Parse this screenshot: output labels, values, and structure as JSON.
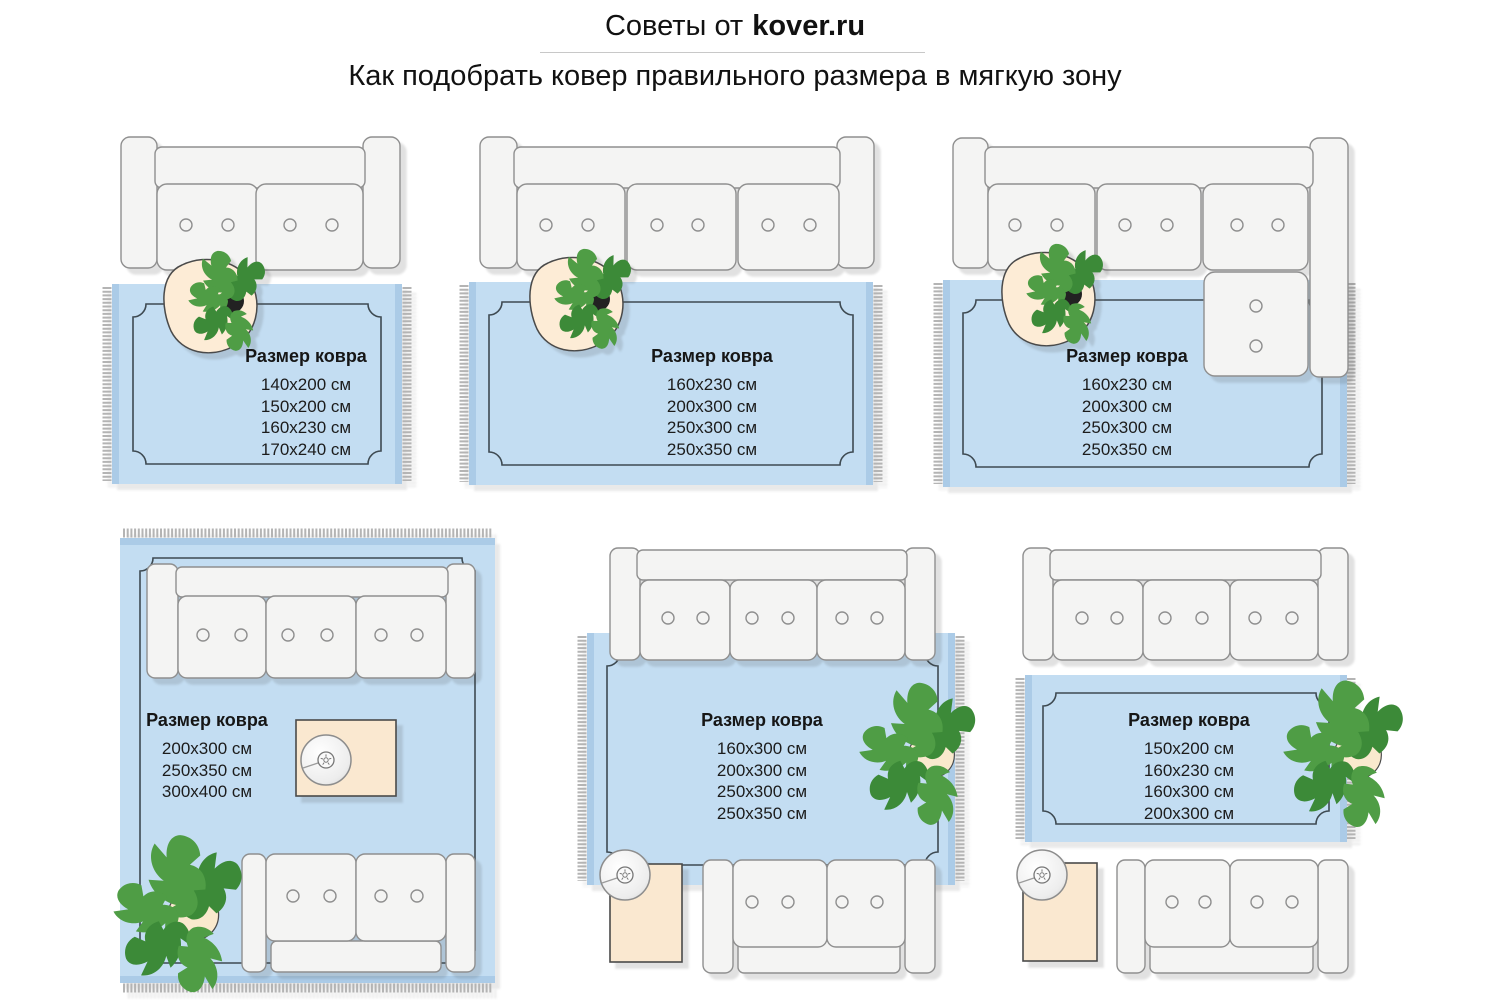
{
  "header": {
    "title_prefix": "Советы от",
    "title_brand": "kover.ru",
    "subtitle": "Как подобрать ковер правильного размера в мягкую зону"
  },
  "panels": [
    {
      "name": "two-seat-sofa",
      "label": "Размер ковра",
      "sizes": [
        "140x200 см",
        "150x200 см",
        "160x230 см",
        "170x240 см"
      ]
    },
    {
      "name": "three-seat-sofa",
      "label": "Размер ковра",
      "sizes": [
        "160x230 см",
        "200x300 см",
        "250x300 см",
        "250x350 см"
      ]
    },
    {
      "name": "corner-sofa",
      "label": "Размер ковра",
      "sizes": [
        "160x230 см",
        "200x300 см",
        "250x300 см",
        "250x350 см"
      ]
    },
    {
      "name": "two-sofas-large-rug",
      "label": "Размер ковра",
      "sizes": [
        "200x300 см",
        "250x350 см",
        "300x400 см"
      ]
    },
    {
      "name": "two-sofas-medium-rug",
      "label": "Размер ковра",
      "sizes": [
        "160x300 см",
        "200x300 см",
        "250x300 см",
        "250x350 см"
      ]
    },
    {
      "name": "sofa-small-rug",
      "label": "Размер ковра",
      "sizes": [
        "150x200 см",
        "160x230 см",
        "160x300 см",
        "200x300 см"
      ]
    }
  ],
  "colors": {
    "rug_blue": "#c3ddf2",
    "rug_edge_band": "#abcbe7",
    "rug_border_line": "#3e4a52",
    "fringe_gray": "#b4b4b4",
    "sofa_fill": "#f4f4f3",
    "sofa_outline": "#8f8f8f",
    "table_cream": "#fae8d0",
    "plant_green": "#4f9d45",
    "plant_green_dark": "#3c8a38",
    "text": "#1a1a1a"
  }
}
